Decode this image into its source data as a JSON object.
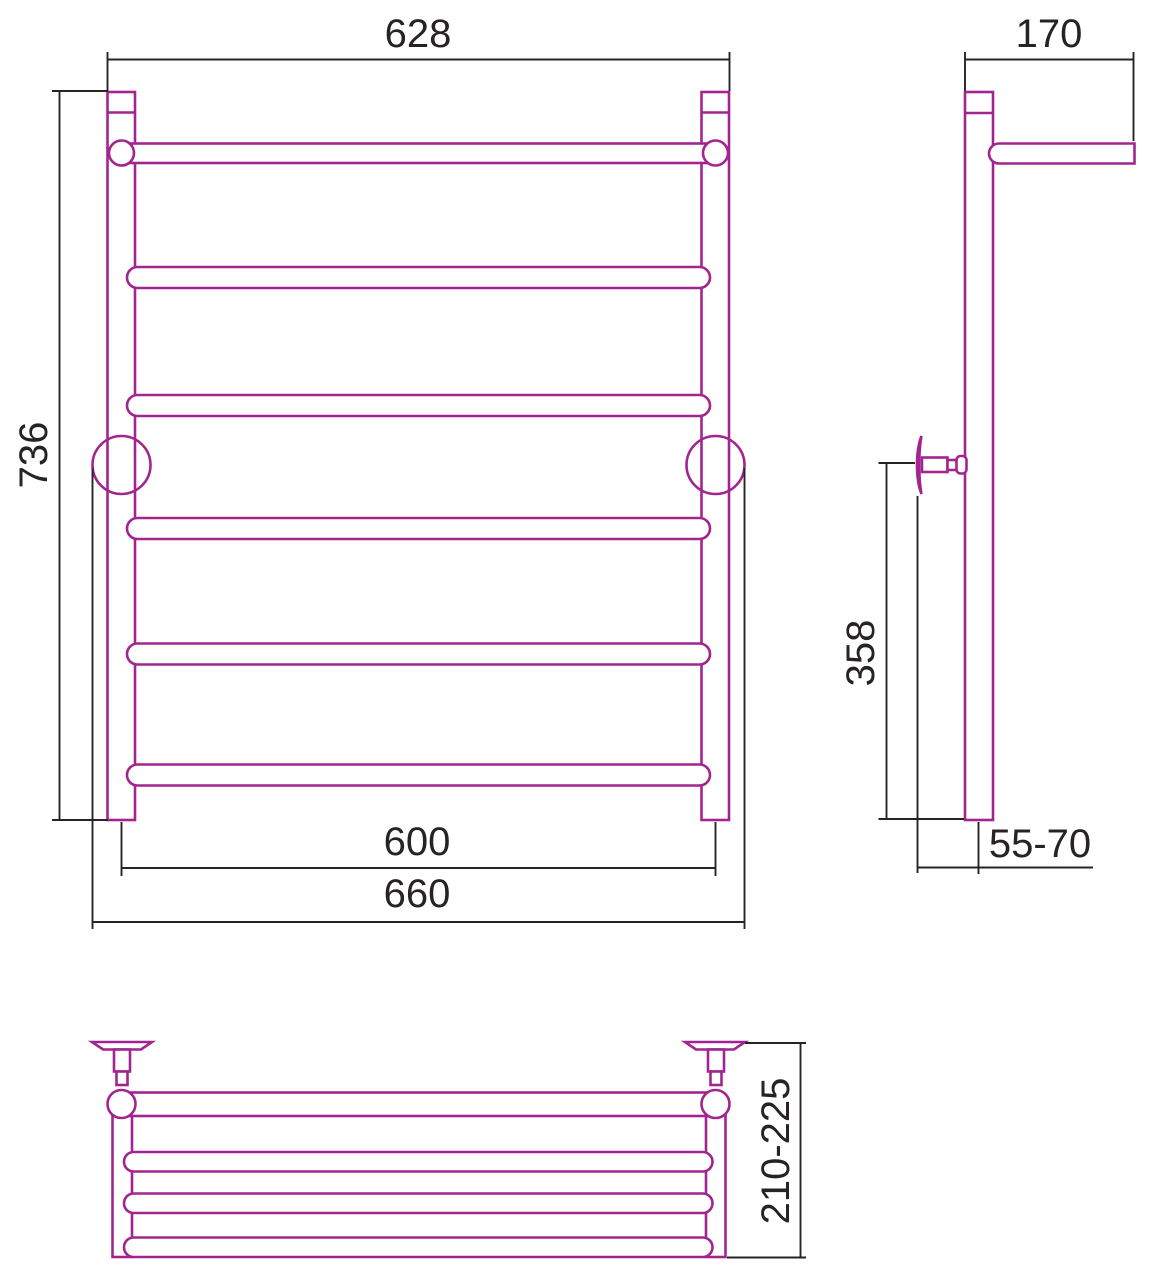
{
  "drawing": {
    "kind": "technical-drawing",
    "subject": "ladder towel rail with top shelf, three orthographic views with dimensions"
  },
  "colors": {
    "product_line": "#A2258F",
    "dimension_line": "#272325",
    "background": "#FFFFFF"
  },
  "views": {
    "front": {
      "dims": {
        "top_width": "628",
        "height": "736",
        "rail_width": "600",
        "bracket_width": "660"
      }
    },
    "side": {
      "dims": {
        "shelf_depth": "170",
        "bracket_to_bottom": "358",
        "wall_to_pipe_axis": "55-70"
      }
    },
    "top": {
      "dims": {
        "total_depth": "210-225"
      }
    }
  }
}
